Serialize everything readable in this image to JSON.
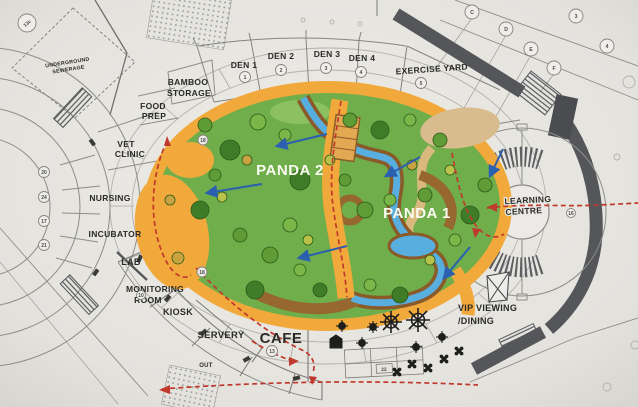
{
  "areas": {
    "underground_1": "UNDERGROUND",
    "underground_2": "SEWERAGE",
    "bamboo_1": "BAMBOO",
    "bamboo_2": "STORAGE",
    "food_1": "FOOD",
    "food_2": "PREP",
    "vet_1": "VET",
    "vet_2": "CLINIC",
    "nursing": "NURSING",
    "incubator": "INCUBATOR",
    "lab": "LAB",
    "monitoring_1": "MONITORING",
    "monitoring_2": "ROOM",
    "kiosk": "KIOSK",
    "servery": "SERVERY",
    "cafe": "CAFE",
    "out": "OUT",
    "exercise_yard": "EXERCISE YARD",
    "learning_1": "LEARNING",
    "learning_2": "CENTRE",
    "vip_1": "VIP VIEWING",
    "vip_2": "/DINING",
    "panda1": "PANDA 1",
    "panda2": "PANDA 2"
  },
  "dens": [
    {
      "label": "DEN 1",
      "num": "1"
    },
    {
      "label": "DEN 2",
      "num": "2"
    },
    {
      "label": "DEN 3",
      "num": "3"
    },
    {
      "label": "DEN 4",
      "num": "4"
    }
  ],
  "markers": {
    "corner_ref": "13c",
    "exercise_yard_num": "5",
    "cafe_num": "13",
    "monitoring_num": "10",
    "enclosure_gate_num": "18",
    "walkway_num": "18",
    "learning_side_num": "16",
    "room_grid_num": "22",
    "left_rooms": [
      "20",
      "24",
      "17",
      "21"
    ],
    "grid_letters": [
      "C",
      "D",
      "E",
      "F"
    ],
    "grid_line_nums": [
      "3",
      "4"
    ]
  },
  "colors": {
    "paper": "#e8e6e1",
    "grass": "#6fae4a",
    "keeper_path": "#f2a93b",
    "earth": "#96682f",
    "water": "#58aede",
    "visitor_route": "#c0392d",
    "flow_arrow": "#2b5fb0",
    "wall": "#54565a"
  }
}
